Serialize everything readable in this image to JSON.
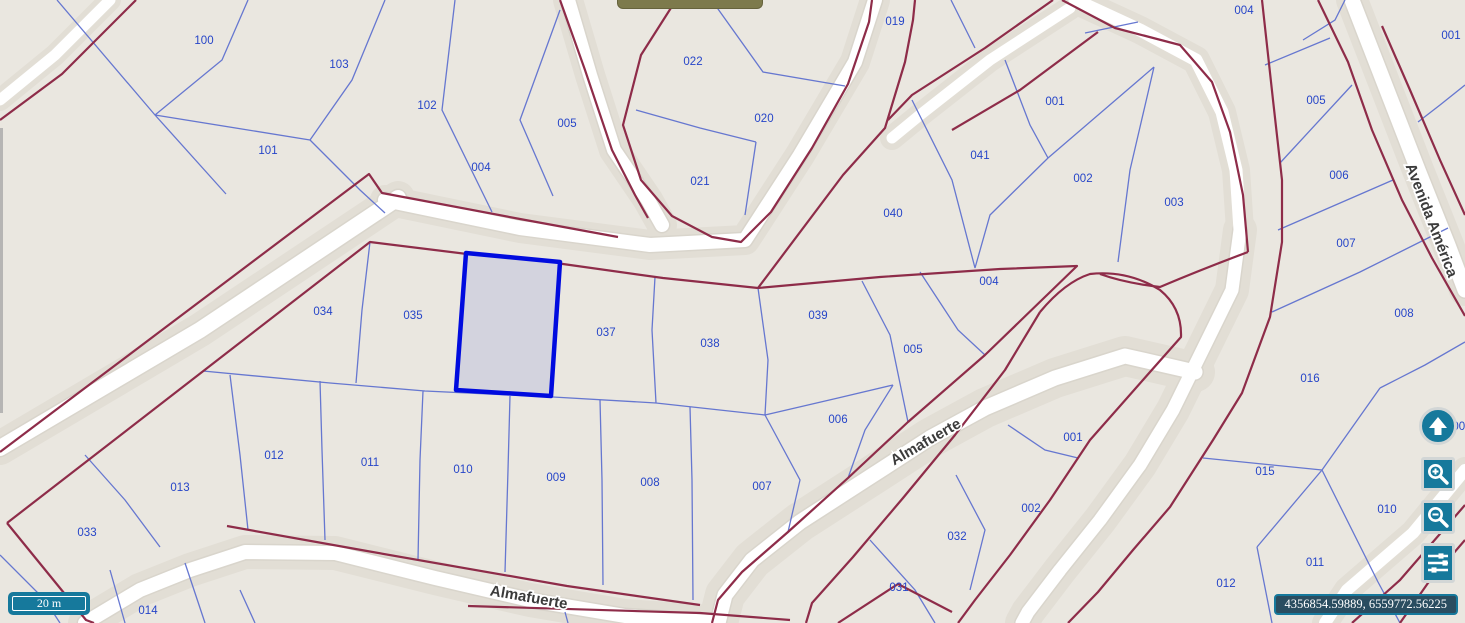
{
  "map": {
    "parcel_labels": [
      {
        "text": "100",
        "x": 204,
        "y": 40
      },
      {
        "text": "103",
        "x": 339,
        "y": 64
      },
      {
        "text": "102",
        "x": 427,
        "y": 105
      },
      {
        "text": "101",
        "x": 268,
        "y": 150
      },
      {
        "text": "005",
        "x": 567,
        "y": 123
      },
      {
        "text": "004",
        "x": 481,
        "y": 167
      },
      {
        "text": "022",
        "x": 693,
        "y": 61
      },
      {
        "text": "020",
        "x": 764,
        "y": 118
      },
      {
        "text": "021",
        "x": 700,
        "y": 181
      },
      {
        "text": "019",
        "x": 895,
        "y": 21
      },
      {
        "text": "040",
        "x": 893,
        "y": 213
      },
      {
        "text": "041",
        "x": 980,
        "y": 155
      },
      {
        "text": "001",
        "x": 1055,
        "y": 101
      },
      {
        "text": "002",
        "x": 1083,
        "y": 178
      },
      {
        "text": "003",
        "x": 1174,
        "y": 202
      },
      {
        "text": "004",
        "x": 989,
        "y": 281
      },
      {
        "text": "005",
        "x": 913,
        "y": 349
      },
      {
        "text": "006",
        "x": 838,
        "y": 419
      },
      {
        "text": "039",
        "x": 818,
        "y": 315
      },
      {
        "text": "034",
        "x": 323,
        "y": 311
      },
      {
        "text": "035",
        "x": 413,
        "y": 315
      },
      {
        "text": "037",
        "x": 606,
        "y": 332
      },
      {
        "text": "038",
        "x": 710,
        "y": 343
      },
      {
        "text": "013",
        "x": 180,
        "y": 487
      },
      {
        "text": "012",
        "x": 274,
        "y": 455
      },
      {
        "text": "011",
        "x": 370,
        "y": 462
      },
      {
        "text": "010",
        "x": 463,
        "y": 469
      },
      {
        "text": "009",
        "x": 556,
        "y": 477
      },
      {
        "text": "008",
        "x": 650,
        "y": 482
      },
      {
        "text": "007",
        "x": 762,
        "y": 486
      },
      {
        "text": "033",
        "x": 87,
        "y": 532
      },
      {
        "text": "014",
        "x": 148,
        "y": 610
      },
      {
        "text": "001",
        "x": 1073,
        "y": 437
      },
      {
        "text": "002",
        "x": 1031,
        "y": 508
      },
      {
        "text": "032",
        "x": 957,
        "y": 536
      },
      {
        "text": "031",
        "x": 899,
        "y": 587
      },
      {
        "text": "004",
        "x": 1244,
        "y": 10
      },
      {
        "text": "001",
        "x": 1451,
        "y": 35
      },
      {
        "text": "005",
        "x": 1316,
        "y": 100
      },
      {
        "text": "006",
        "x": 1339,
        "y": 175
      },
      {
        "text": "007",
        "x": 1346,
        "y": 243
      },
      {
        "text": "008",
        "x": 1404,
        "y": 313
      },
      {
        "text": "016",
        "x": 1310,
        "y": 378
      },
      {
        "text": "015",
        "x": 1265,
        "y": 471
      },
      {
        "text": "010",
        "x": 1387,
        "y": 509
      },
      {
        "text": "011",
        "x": 1315,
        "y": 562
      },
      {
        "text": "012",
        "x": 1226,
        "y": 583
      },
      {
        "text": "008",
        "x": 1462,
        "y": 426
      }
    ],
    "street_labels": [
      {
        "text": "Almafuerte",
        "x": 928,
        "y": 446,
        "rotation": -30
      },
      {
        "text": "Almafuerte",
        "x": 528,
        "y": 602,
        "rotation": 10
      },
      {
        "text": "Avenida América",
        "x": 1427,
        "y": 222,
        "rotation": 69
      }
    ],
    "colors": {
      "ground": "#eae7e0",
      "road": "#ffffff",
      "block_line": "#8e2c49",
      "parcel_line": "#5f71cf",
      "label": "#2645c8",
      "selected_stroke": "#000bdf",
      "selected_fill": "#d3d3de",
      "teal": "#16799c",
      "street_text": "#3b3b3b"
    }
  },
  "controls": {
    "scale_bar": {
      "label": "20 m"
    },
    "coordinates": {
      "value": "4356854.59889, 6559772.56225"
    },
    "buttons": [
      {
        "name": "pan-north",
        "icon": "arrow-up-icon"
      },
      {
        "name": "zoom-in",
        "icon": "magnifier-plus-icon"
      },
      {
        "name": "zoom-out",
        "icon": "magnifier-minus-icon"
      },
      {
        "name": "layer-settings",
        "icon": "sliders-icon"
      }
    ]
  }
}
